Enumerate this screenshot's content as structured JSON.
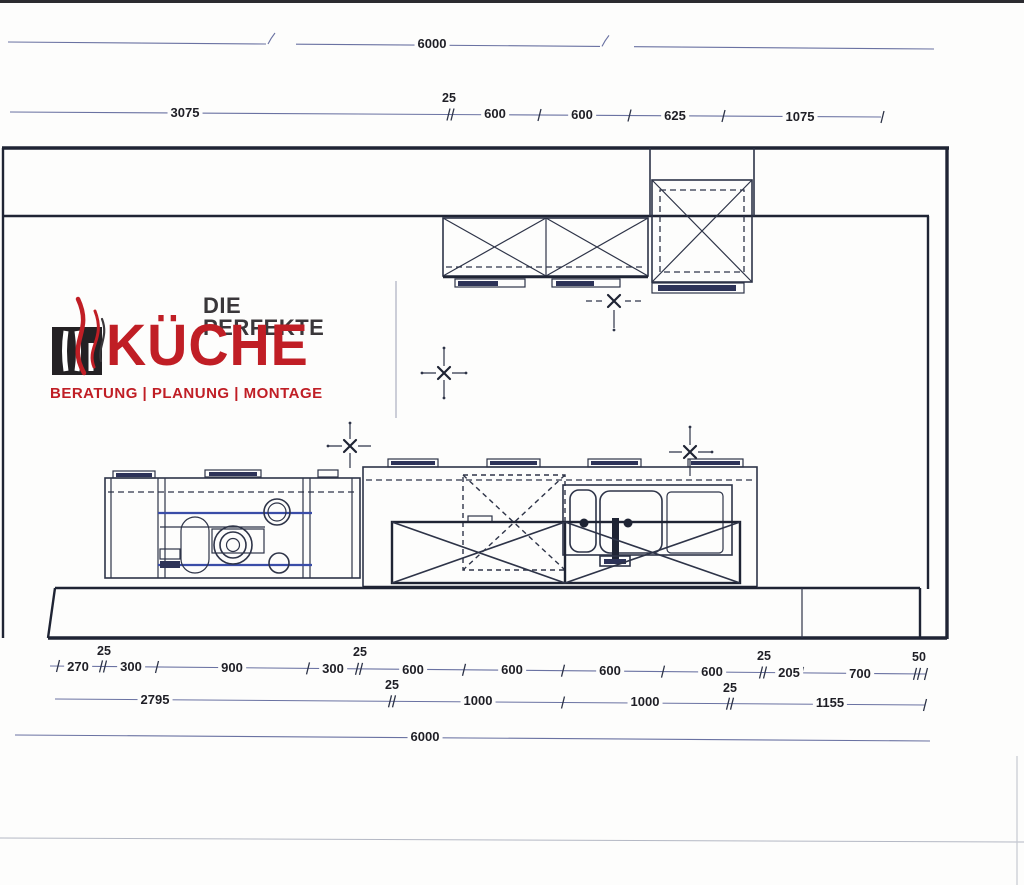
{
  "colors": {
    "ink": "#2e3448",
    "ink_dark": "#1f2434",
    "blue": "#3a4da8",
    "blue_dark": "#2d3358",
    "dim_line": "#6a72a2",
    "label": "#1f1f26",
    "logo_red": "#c01e25",
    "logo_dark": "#3a373a"
  },
  "logo": {
    "tagline_top": "DIE PERFEKTE",
    "brand": "KÜCHE",
    "tagline_bottom": "BERATUNG | PLANUNG | MONTAGE"
  },
  "dimensions": {
    "top_total": "6000",
    "bottom_total": "6000",
    "upper_chain": [
      "3075",
      "25",
      "600",
      "600",
      "625",
      "1075"
    ],
    "base_chain": [
      "270",
      "25",
      "300",
      "900",
      "300",
      "25",
      "600",
      "600",
      "600",
      "600",
      "25",
      "205",
      "700",
      "50"
    ],
    "mid_chain": [
      "2795",
      "25",
      "1000",
      "1000",
      "25",
      "1155"
    ]
  }
}
